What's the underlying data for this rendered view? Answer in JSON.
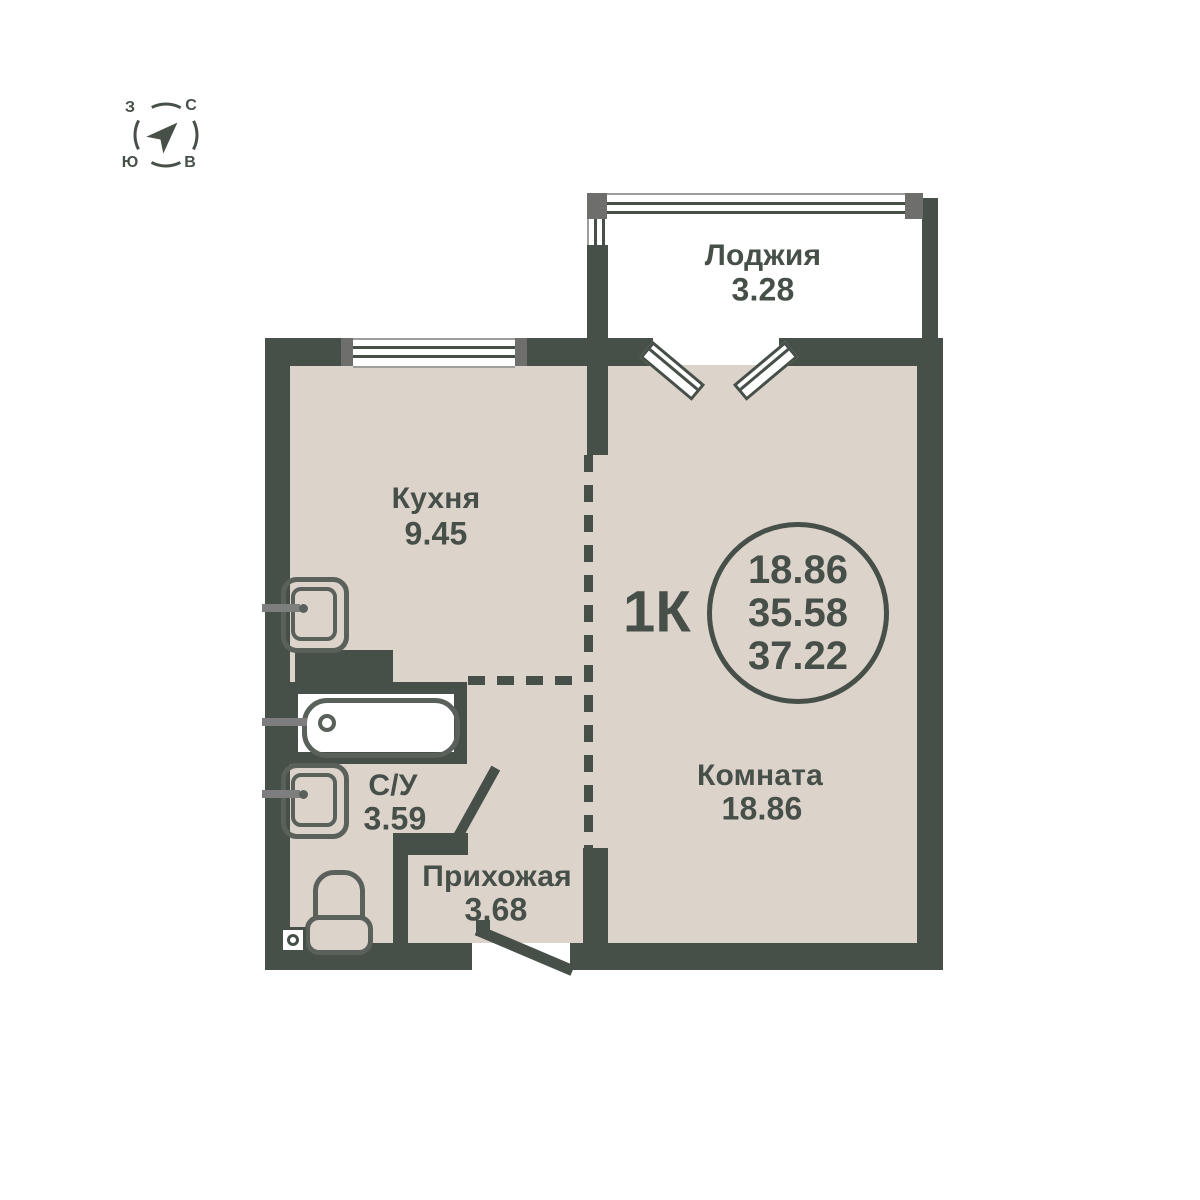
{
  "compass": {
    "west": "З",
    "north": "С",
    "south": "Ю",
    "east": "В"
  },
  "rooms": {
    "loggia": {
      "label": "Лоджия",
      "area": "3.28"
    },
    "kitchen": {
      "label": "Кухня",
      "area": "9.45"
    },
    "room": {
      "label": "Комната",
      "area": "18.86"
    },
    "bathroom": {
      "label": "С/У",
      "area": "3.59"
    },
    "hallway": {
      "label": "Прихожая",
      "area": "3.68"
    }
  },
  "apartment": {
    "type_label": "1К",
    "circle_values": [
      "18.86",
      "35.58",
      "37.22"
    ]
  },
  "icons": {
    "compass_arrow": "north-direction-arrow",
    "kitchen_sink": "sink",
    "bathroom_sink": "sink",
    "bathtub": "bathtub",
    "toilet": "toilet",
    "floor_drain": "floor-drain"
  },
  "colors": {
    "wall": "#474F49",
    "floor": "#DCD3CB",
    "fixture": "#5A605A",
    "tap": "#7E7E7E",
    "post": "#6E6E6C",
    "frame": "#9E9E9A",
    "text": "#474F49",
    "white": "#FFFFFF"
  }
}
